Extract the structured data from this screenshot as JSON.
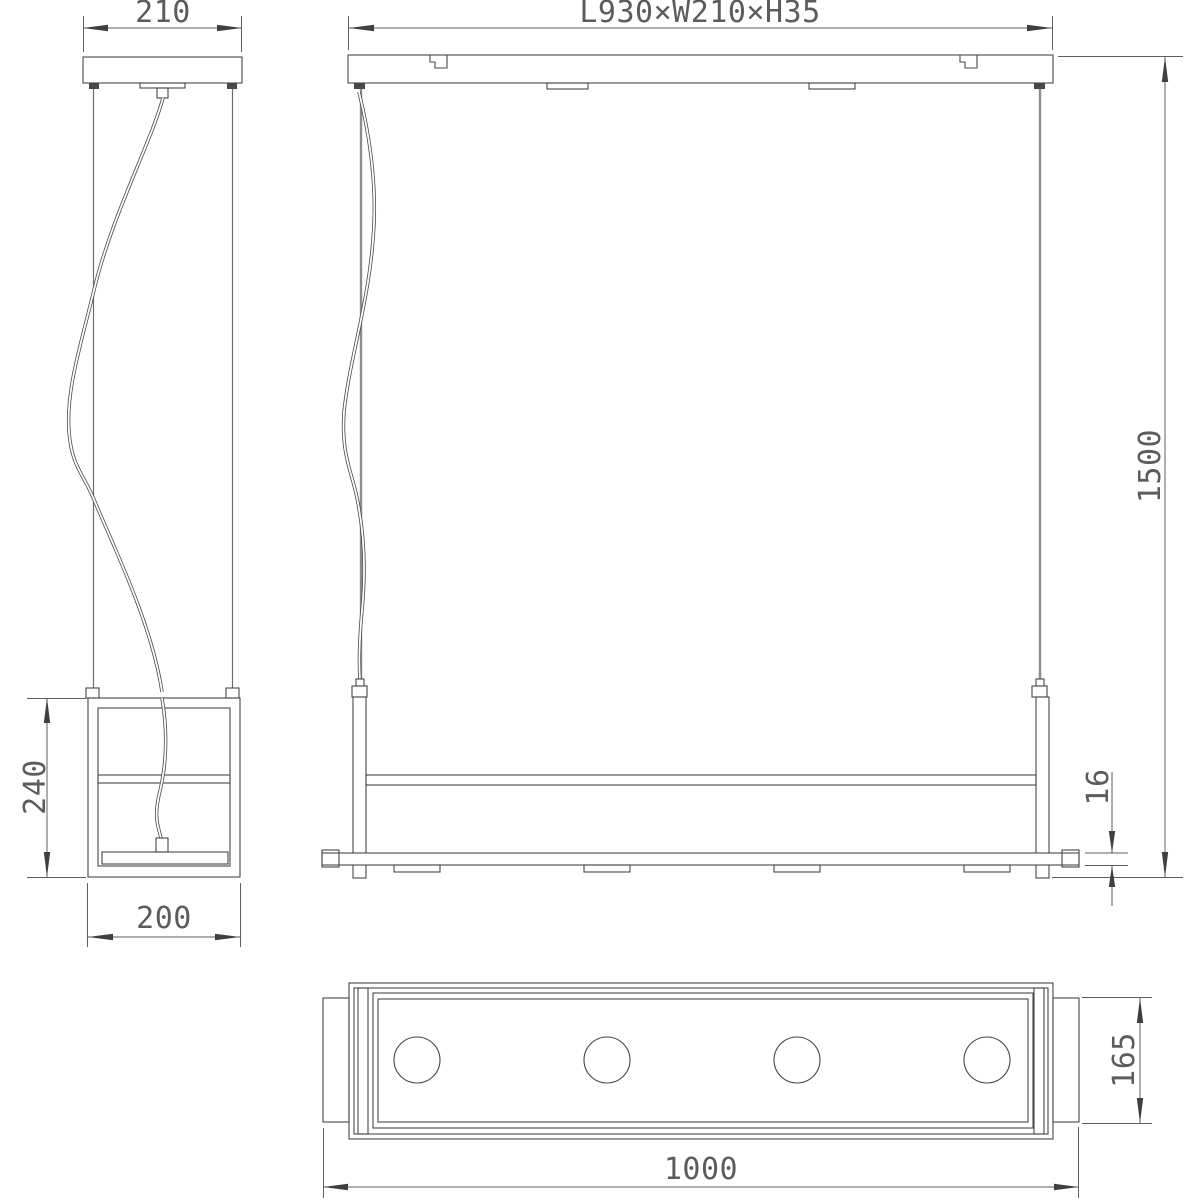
{
  "drawing": {
    "title": "Linear pendant luminaire dimension drawing",
    "style": "CAD line drawing, black lines on white",
    "line_color": "#474747",
    "text_color": "#5c5c5c",
    "background": "#ffffff",
    "views": [
      {
        "id": "side-view",
        "description": "Side elevation with canopy, suspension wires, power cord and rectangular frame"
      },
      {
        "id": "front-view",
        "description": "Front elevation with ceiling rail, two suspension cables, frame posts and shelf bar"
      },
      {
        "id": "bottom-view",
        "description": "Bottom view of luminaire body with four round LED lenses"
      }
    ],
    "led_count": 4
  },
  "dims": {
    "canopy_width": "210",
    "fixture_lwh": "L930×W210×H35",
    "drop_height": "1500",
    "side_height": "240",
    "side_width": "200",
    "shelf_thickness": "16",
    "body_width": "165",
    "overall_length": "1000"
  }
}
